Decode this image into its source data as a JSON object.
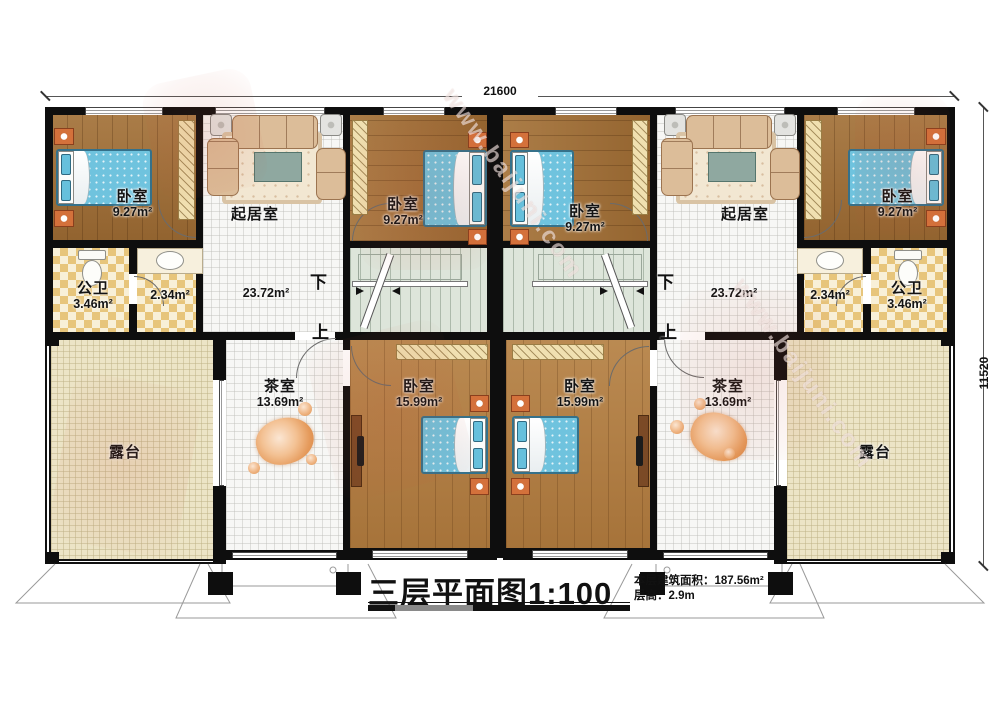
{
  "title": {
    "main": "三层平面图",
    "scale": "1:100",
    "area_label": "本层建筑面积：",
    "area_value": "187.56m²",
    "height_label": "层高：",
    "height_value": "2.9m"
  },
  "dimensions": {
    "width": "21600",
    "height": "11520"
  },
  "stairs": {
    "down": "下",
    "up": "上"
  },
  "rooms": {
    "bedroom_tl": {
      "name": "卧室",
      "area": "9.27m²"
    },
    "bedroom_cl": {
      "name": "卧室",
      "area": "9.27m²"
    },
    "bedroom_cr": {
      "name": "卧室",
      "area": "9.27m²"
    },
    "bedroom_tr": {
      "name": "卧室",
      "area": "9.27m²"
    },
    "living_l": {
      "name": "起居室",
      "area": "23.72m²"
    },
    "living_r": {
      "name": "起居室",
      "area": "23.72m²"
    },
    "bath_l": {
      "name": "公卫",
      "area": "3.46m²"
    },
    "hall_l": {
      "area": "2.34m²"
    },
    "hall_r": {
      "area": "2.34m²"
    },
    "bath_r": {
      "name": "公卫",
      "area": "3.46m²"
    },
    "tea_l": {
      "name": "茶室",
      "area": "13.69m²"
    },
    "tea_r": {
      "name": "茶室",
      "area": "13.69m²"
    },
    "bedroom_bl": {
      "name": "卧室",
      "area": "15.99m²"
    },
    "bedroom_br": {
      "name": "卧室",
      "area": "15.99m²"
    },
    "terrace_l": {
      "name": "露台"
    },
    "terrace_r": {
      "name": "露台"
    }
  },
  "watermark": {
    "url": "www.baijuni.com"
  }
}
